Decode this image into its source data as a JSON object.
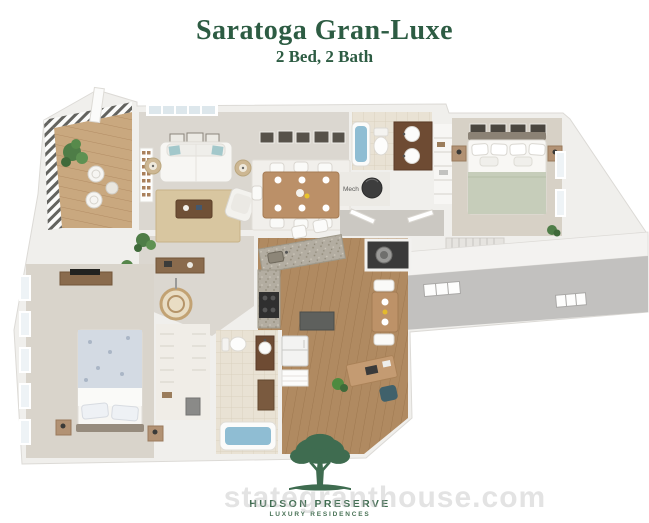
{
  "header": {
    "title": "Saratoga Gran-Luxe",
    "subtitle": "2 Bed, 2 Bath"
  },
  "floor_plan": {
    "mech_label": "Mech"
  },
  "logo": {
    "name_display": "HUDSON PRESERVE",
    "tagline": "LUXURY RESIDENCES"
  },
  "watermark": {
    "text": "stategranthouse.com"
  },
  "colors": {
    "title_green": "#2d5c43",
    "logo_green": "#3f6c50",
    "carpet": "#dbd7d0",
    "wood_floor": "#b08a61",
    "tub_water": "#8fbdd3",
    "exterior_wall_gray": "#c2c1bf"
  }
}
